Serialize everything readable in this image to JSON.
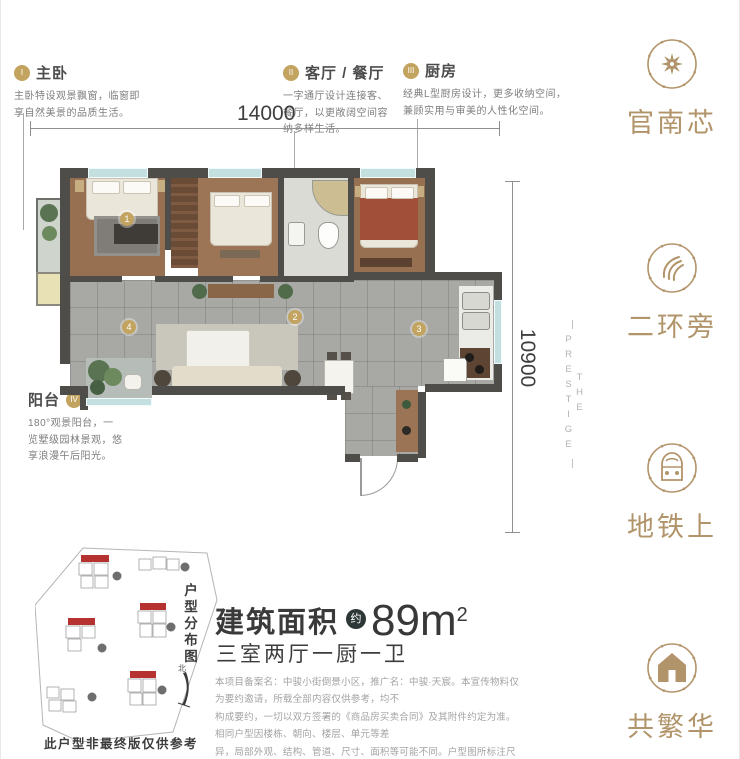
{
  "colors": {
    "gold_accent": "#b2946a",
    "marker_gold": "#c2a35f",
    "wall_dark": "#4e4d49",
    "building_red": "#b63230",
    "text_dark": "#3c3c3c",
    "text_gray": "#a3a3a3"
  },
  "watermark": {
    "text": "THE PRESTIGE"
  },
  "dimensions": {
    "width_label": "14000",
    "height_label": "10900"
  },
  "annotations": [
    {
      "numeral": "I",
      "title": "主卧",
      "lines": [
        "主卧特设观景飘窗，临窗即",
        "享自然美景的品质生活。"
      ]
    },
    {
      "numeral": "II",
      "title": "客厅 / 餐厅",
      "lines": [
        "一字通厅设计连接客、",
        "餐厅，以更敞阔空间容",
        "纳多样生活。"
      ]
    },
    {
      "numeral": "III",
      "title": "厨房",
      "lines": [
        "经典L型厨房设计，更多收纳空间，",
        "兼顾实用与审美的人性化空间。"
      ]
    },
    {
      "numeral": "IV",
      "title": "阳台",
      "lines": [
        "180°观景阳台，一",
        "览墅级园林景观，悠",
        "享浪漫午后阳光。"
      ]
    }
  ],
  "floorplan": {
    "markers": [
      "1",
      "2",
      "3",
      "4"
    ]
  },
  "sidebar": {
    "items": [
      {
        "icon": "compass-star-icon",
        "label": "官南芯"
      },
      {
        "icon": "swirl-icon",
        "label": "二环旁"
      },
      {
        "icon": "train-icon",
        "label": "地铁上"
      },
      {
        "icon": "house-icon",
        "label": "共繁华"
      }
    ]
  },
  "area": {
    "prefix": "建筑面积",
    "approx_badge": "约",
    "value": "89m",
    "sup": "2",
    "subtitle": "三室两厅一厨一卫"
  },
  "siteplan": {
    "title": "户型分布图",
    "north_label": "北",
    "caption": "此户型非最终版仅供参考"
  },
  "disclaimer": {
    "lines": [
      "本项目备案名：中骏小街倒景小区，推广名：中骏·天宸。本宣传物料仅为要约邀请，所载全部内容仅供参考，均不",
      "构成要约，一切以双方签署的《商品房买卖合同》及其附件约定为准。相同户型因楼栋、朝向、楼层、单元等差",
      "异，局部外观、结构、管道、尺寸、面积等可能不同。户型图所标注尺寸单位为：毫米。开发商：云南世博华兆置",
      "业有限公司。制作日期：2020年8月。敬请留意最新宣传物料。"
    ]
  }
}
